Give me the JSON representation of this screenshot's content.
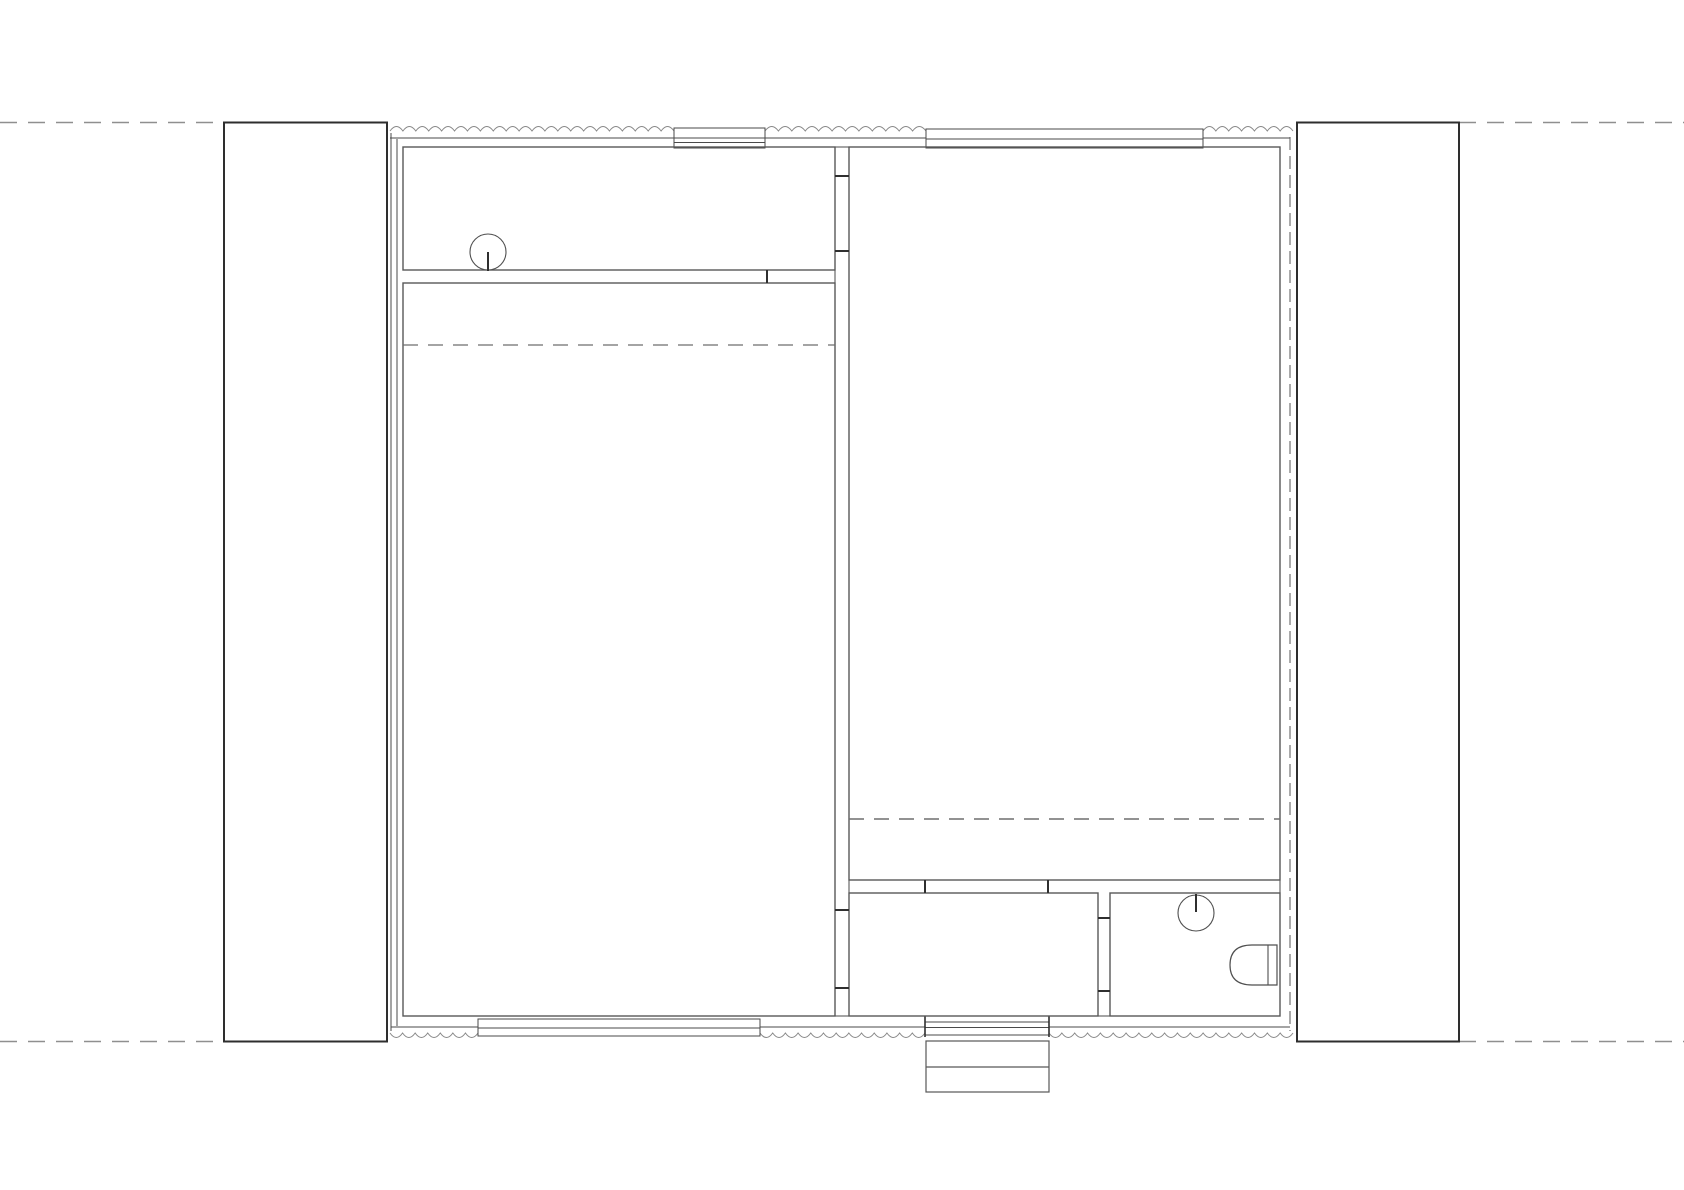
{
  "canvas": {
    "width": 1684,
    "height": 1190,
    "background": "#ffffff"
  },
  "palette": {
    "guide": "#8f8f8f",
    "column": "#2e2e2e",
    "wall": "#4a4a4a",
    "room": "#585858",
    "tick": "#2f2f2f",
    "hidden": "#6e6e6e",
    "insulation": "#8a8a8a",
    "wall_hidden": "#555555",
    "fixture": "#4f4f4f",
    "white": "#ffffff",
    "none": "none"
  },
  "guide_lines": [
    {
      "name": "guide-line-top-west",
      "type": "line",
      "x1": 0,
      "y1": 122.5,
      "x2": 224,
      "y2": 122.5,
      "stroke": "guide",
      "width": 1.6,
      "dash": "17 11"
    },
    {
      "name": "guide-line-top-east",
      "type": "line",
      "x1": 1459,
      "y1": 122.5,
      "x2": 1684,
      "y2": 122.5,
      "stroke": "guide",
      "width": 1.6,
      "dash": "17 11"
    },
    {
      "name": "guide-line-bottom-west",
      "type": "line",
      "x1": 0,
      "y1": 1041.5,
      "x2": 224,
      "y2": 1041.5,
      "stroke": "guide",
      "width": 1.6,
      "dash": "17 11"
    },
    {
      "name": "guide-line-bottom-east",
      "type": "line",
      "x1": 1459,
      "y1": 1041.5,
      "x2": 1684,
      "y2": 1041.5,
      "stroke": "guide",
      "width": 1.6,
      "dash": "17 11"
    }
  ],
  "columns": [
    {
      "name": "pier-west",
      "type": "rect",
      "x": 224,
      "y": 122.5,
      "w": 163,
      "h": 919,
      "stroke": "column",
      "width": 2,
      "fill": "white"
    },
    {
      "name": "pier-east",
      "type": "rect",
      "x": 1297,
      "y": 122.5,
      "w": 162,
      "h": 919,
      "stroke": "column",
      "width": 2,
      "fill": "white"
    }
  ],
  "wall_lines": [
    {
      "name": "west-wall-outer-face",
      "type": "line",
      "x1": 391,
      "y1": 133,
      "x2": 391,
      "y2": 1031,
      "stroke": "wall",
      "width": 1
    },
    {
      "name": "west-wall-inner-face",
      "type": "line",
      "x1": 397,
      "y1": 139,
      "x2": 397,
      "y2": 1026,
      "stroke": "wall",
      "width": 1
    },
    {
      "name": "north-wall-face-west-seg",
      "type": "line",
      "x1": 390,
      "y1": 138,
      "x2": 674,
      "y2": 138,
      "stroke": "wall",
      "width": 1
    },
    {
      "name": "north-wall-face-mid-seg",
      "type": "line",
      "x1": 765,
      "y1": 138,
      "x2": 926,
      "y2": 138,
      "stroke": "wall",
      "width": 1
    },
    {
      "name": "north-wall-face-east-seg",
      "type": "line",
      "x1": 1203,
      "y1": 138,
      "x2": 1290,
      "y2": 138,
      "stroke": "wall",
      "width": 1
    },
    {
      "name": "south-wall-face-west-seg",
      "type": "line",
      "x1": 391,
      "y1": 1027,
      "x2": 478,
      "y2": 1027,
      "stroke": "wall",
      "width": 1
    },
    {
      "name": "south-wall-face-mid-seg",
      "type": "line",
      "x1": 760,
      "y1": 1027,
      "x2": 925,
      "y2": 1027,
      "stroke": "wall",
      "width": 1
    },
    {
      "name": "south-wall-face-east-seg",
      "type": "line",
      "x1": 1049,
      "y1": 1027,
      "x2": 1290,
      "y2": 1027,
      "stroke": "wall",
      "width": 1
    },
    {
      "name": "partition-head-band",
      "type": "line",
      "x1": 835,
      "y1": 147,
      "x2": 849,
      "y2": 147,
      "stroke": "wall",
      "width": 1
    },
    {
      "name": "partition-band-upper-rooms",
      "type": "line",
      "x1": 835,
      "y1": 270,
      "x2": 835,
      "y2": 283,
      "stroke": "wall",
      "width": 1
    },
    {
      "name": "partition-sill-band-west",
      "type": "line",
      "x1": 835,
      "y1": 1016,
      "x2": 849,
      "y2": 1016,
      "stroke": "wall",
      "width": 1
    },
    {
      "name": "partition-sill-band-east",
      "type": "line",
      "x1": 1098,
      "y1": 1016,
      "x2": 1110,
      "y2": 1016,
      "stroke": "wall",
      "width": 1
    },
    {
      "name": "east-wall-inner-band",
      "type": "line",
      "x1": 1280,
      "y1": 880,
      "x2": 1280,
      "y2": 893,
      "stroke": "wall",
      "width": 1
    },
    {
      "name": "partition-east-band",
      "type": "line",
      "x1": 849,
      "y1": 880,
      "x2": 849,
      "y2": 893,
      "stroke": "wall",
      "width": 1
    }
  ],
  "hidden_wall_lines": [
    {
      "name": "east-wall-outer-face-hidden",
      "type": "line",
      "x1": 1290,
      "y1": 137,
      "x2": 1290,
      "y2": 1031,
      "stroke": "wall_hidden",
      "width": 1,
      "dash": "13 6"
    }
  ],
  "insulation_runs": [
    {
      "name": "insulation-north-west",
      "type": "wavy",
      "x1": 390,
      "x2": 674,
      "y": 131,
      "dir": -1,
      "wavelength": 13,
      "rise": 9,
      "stroke": "insulation",
      "width": 1
    },
    {
      "name": "insulation-north-mid",
      "type": "wavy",
      "x1": 765,
      "x2": 926,
      "y": 131,
      "dir": -1,
      "wavelength": 13,
      "rise": 9,
      "stroke": "insulation",
      "width": 1
    },
    {
      "name": "insulation-north-east",
      "type": "wavy",
      "x1": 1203,
      "x2": 1293,
      "y": 131,
      "dir": -1,
      "wavelength": 13,
      "rise": 9,
      "stroke": "insulation",
      "width": 1
    },
    {
      "name": "insulation-south-west",
      "type": "wavy",
      "x1": 390,
      "x2": 478,
      "y": 1033,
      "dir": 1,
      "wavelength": 13,
      "rise": 9,
      "stroke": "insulation",
      "width": 1
    },
    {
      "name": "insulation-south-mid",
      "type": "wavy",
      "x1": 760,
      "x2": 925,
      "y": 1033,
      "dir": 1,
      "wavelength": 13,
      "rise": 9,
      "stroke": "insulation",
      "width": 1
    },
    {
      "name": "insulation-south-east",
      "type": "wavy",
      "x1": 1049,
      "x2": 1293,
      "y": 1033,
      "dir": 1,
      "wavelength": 13,
      "rise": 9,
      "stroke": "insulation",
      "width": 1
    }
  ],
  "window_units": [
    {
      "name": "window-north-west-frame",
      "type": "rect",
      "x": 674,
      "y": 128,
      "w": 91,
      "h": 20,
      "stroke": "wall",
      "width": 1,
      "fill": "white"
    },
    {
      "name": "window-north-west-pane-1",
      "type": "line",
      "x1": 674,
      "y1": 138,
      "x2": 765,
      "y2": 138,
      "stroke": "wall",
      "width": 1
    },
    {
      "name": "window-north-west-pane-2",
      "type": "line",
      "x1": 674,
      "y1": 142.5,
      "x2": 765,
      "y2": 142.5,
      "stroke": "wall",
      "width": 1
    },
    {
      "name": "window-north-east-frame",
      "type": "rect",
      "x": 926,
      "y": 129,
      "w": 277,
      "h": 19,
      "stroke": "wall",
      "width": 1,
      "fill": "white"
    },
    {
      "name": "window-north-east-pane",
      "type": "line",
      "x1": 926,
      "y1": 139,
      "x2": 1203,
      "y2": 139,
      "stroke": "wall",
      "width": 1
    },
    {
      "name": "window-south-west-frame",
      "type": "rect",
      "x": 478,
      "y": 1019,
      "w": 282,
      "h": 17,
      "stroke": "wall",
      "width": 1,
      "fill": "white"
    },
    {
      "name": "window-south-west-pane",
      "type": "line",
      "x1": 478,
      "y1": 1028,
      "x2": 760,
      "y2": 1028,
      "stroke": "wall",
      "width": 1
    }
  ],
  "entry_door_parts": [
    {
      "name": "entry-door-leaf",
      "type": "rect",
      "x": 925,
      "y": 1022,
      "w": 124,
      "h": 13,
      "stroke": "wall",
      "width": 1,
      "fill": "white"
    },
    {
      "name": "entry-door-leaf-line",
      "type": "line",
      "x1": 925,
      "y1": 1027.5,
      "x2": 1049,
      "y2": 1027.5,
      "stroke": "wall",
      "width": 1
    },
    {
      "name": "entry-door-jamb-west",
      "type": "line",
      "x1": 925,
      "y1": 1016,
      "x2": 925,
      "y2": 1037,
      "stroke": "tick",
      "width": 1.6
    },
    {
      "name": "entry-door-jamb-east",
      "type": "line",
      "x1": 1049,
      "y1": 1016,
      "x2": 1049,
      "y2": 1037,
      "stroke": "tick",
      "width": 1.6
    }
  ],
  "rooms": [
    {
      "name": "room-utility-northwest",
      "type": "rect",
      "x": 403,
      "y": 147,
      "w": 432,
      "h": 123,
      "stroke": "room",
      "width": 1.4,
      "fill": "none"
    },
    {
      "name": "room-main-west",
      "type": "rect",
      "x": 403,
      "y": 283,
      "w": 432,
      "h": 733,
      "stroke": "room",
      "width": 1.4,
      "fill": "none"
    },
    {
      "name": "room-main-east",
      "type": "rect",
      "x": 849,
      "y": 147,
      "w": 431,
      "h": 733,
      "stroke": "room",
      "width": 1.4,
      "fill": "none"
    },
    {
      "name": "room-vestibule-south",
      "type": "rect",
      "x": 849,
      "y": 893,
      "w": 249,
      "h": 123,
      "stroke": "room",
      "width": 1.4,
      "fill": "none"
    },
    {
      "name": "room-bathroom-southeast",
      "type": "rect",
      "x": 1110,
      "y": 893,
      "w": 170,
      "h": 123,
      "stroke": "room",
      "width": 1.4,
      "fill": "none"
    }
  ],
  "door_jambs": [
    {
      "name": "jamb-partition-upper-door-top",
      "type": "line",
      "x1": 835,
      "y1": 176,
      "x2": 849,
      "y2": 176,
      "stroke": "tick",
      "width": 2
    },
    {
      "name": "jamb-partition-upper-door-bottom",
      "type": "line",
      "x1": 835,
      "y1": 251,
      "x2": 849,
      "y2": 251,
      "stroke": "tick",
      "width": 2
    },
    {
      "name": "jamb-partition-lower-door-top",
      "type": "line",
      "x1": 835,
      "y1": 910,
      "x2": 849,
      "y2": 910,
      "stroke": "tick",
      "width": 2
    },
    {
      "name": "jamb-partition-lower-door-bottom",
      "type": "line",
      "x1": 835,
      "y1": 988,
      "x2": 849,
      "y2": 988,
      "stroke": "tick",
      "width": 2
    },
    {
      "name": "jamb-bathroom-door-top",
      "type": "line",
      "x1": 1098,
      "y1": 918,
      "x2": 1110,
      "y2": 918,
      "stroke": "tick",
      "width": 2
    },
    {
      "name": "jamb-bathroom-door-bottom",
      "type": "line",
      "x1": 1098,
      "y1": 991,
      "x2": 1110,
      "y2": 991,
      "stroke": "tick",
      "width": 2
    },
    {
      "name": "jamb-vestibule-opening-west",
      "type": "line",
      "x1": 925,
      "y1": 880,
      "x2": 925,
      "y2": 893,
      "stroke": "tick",
      "width": 2
    },
    {
      "name": "jamb-vestibule-opening-east",
      "type": "line",
      "x1": 1048,
      "y1": 880,
      "x2": 1048,
      "y2": 893,
      "stroke": "tick",
      "width": 2
    },
    {
      "name": "jamb-utility-wall-divider",
      "type": "line",
      "x1": 767,
      "y1": 270,
      "x2": 767,
      "y2": 283,
      "stroke": "tick",
      "width": 2
    }
  ],
  "loft_edges": [
    {
      "name": "loft-edge-dashed-west",
      "type": "line",
      "x1": 403,
      "y1": 345,
      "x2": 835,
      "y2": 345,
      "stroke": "hidden",
      "width": 1.3,
      "dash": "15 10"
    },
    {
      "name": "loft-edge-dashed-east",
      "type": "line",
      "x1": 849,
      "y1": 819,
      "x2": 1280,
      "y2": 819,
      "stroke": "hidden",
      "width": 1.6,
      "dash": "15 10"
    }
  ],
  "fixtures": [
    {
      "name": "sink-basin-utility",
      "type": "circle",
      "cx": 488,
      "cy": 252,
      "r": 18,
      "stroke": "fixture",
      "width": 1.1,
      "fill": "white"
    },
    {
      "name": "sink-spout-utility",
      "type": "line",
      "x1": 488,
      "y1": 252,
      "x2": 488,
      "y2": 271,
      "stroke": "tick",
      "width": 2
    },
    {
      "name": "sink-basin-bathroom",
      "type": "circle",
      "cx": 1196,
      "cy": 913,
      "r": 18,
      "stroke": "fixture",
      "width": 1.1,
      "fill": "white"
    },
    {
      "name": "sink-spout-bathroom",
      "type": "line",
      "x1": 1196,
      "y1": 894,
      "x2": 1196,
      "y2": 912,
      "stroke": "tick",
      "width": 2
    },
    {
      "name": "toilet-bowl",
      "type": "path",
      "d": "M 1277 945 L 1252 945 Q 1230 945 1230 965 Q 1230 985 1252 985 L 1277 985 Z",
      "stroke": "fixture",
      "width": 1.2,
      "fill": "white"
    },
    {
      "name": "toilet-tank-line",
      "type": "line",
      "x1": 1268,
      "y1": 945,
      "x2": 1268,
      "y2": 985,
      "stroke": "fixture",
      "width": 1.1
    }
  ],
  "steps_parts": [
    {
      "name": "entry-steps-outline",
      "type": "rect",
      "x": 926,
      "y": 1041,
      "w": 123,
      "h": 51,
      "stroke": "room",
      "width": 1.2,
      "fill": "white"
    },
    {
      "name": "entry-steps-tread",
      "type": "line",
      "x1": 926,
      "y1": 1067,
      "x2": 1049,
      "y2": 1067,
      "stroke": "room",
      "width": 1.2
    }
  ],
  "render_order": [
    "guide_lines",
    "columns",
    "wall_lines",
    "hidden_wall_lines",
    "insulation_runs",
    "window_units",
    "entry_door_parts",
    "rooms",
    "door_jambs",
    "loft_edges",
    "fixtures",
    "steps_parts"
  ]
}
